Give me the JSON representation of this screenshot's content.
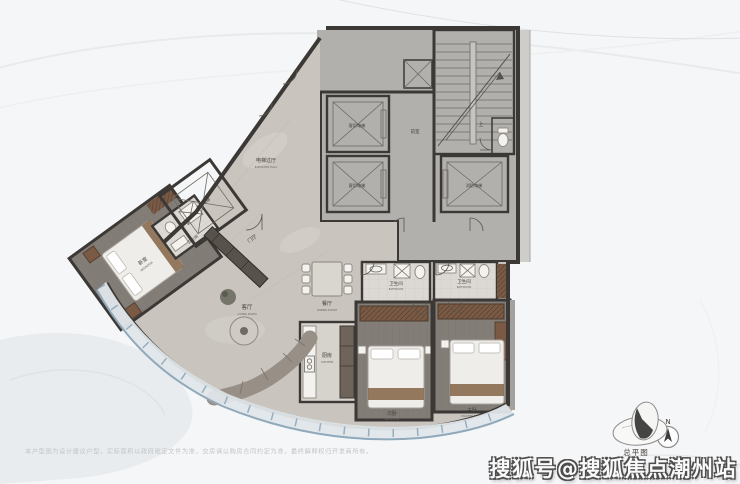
{
  "labels": {
    "elevator_hall": "电梯过厅",
    "elevator_hall_sub": "ELEVATOR HALL",
    "front_room": "前室",
    "up": "上",
    "elevator_passenger": "客用电梯",
    "elevator_fire": "消防电梯",
    "foyer": "门厅",
    "living": "客厅",
    "living_sub": "LIVING ROOM",
    "dining": "餐厅",
    "dining_sub": "DINING ROOM",
    "kitchen": "厨房",
    "kitchen_sub": "KITCHEN",
    "bathroom": "卫生间",
    "bathroom_sub": "BATHROOM",
    "bedroom": "卧室",
    "bedroom_sub": "BEDROOM",
    "bedroom_second": "次卧",
    "bedroom_master": "主卧",
    "bedroom_master_sub": "MASTER ROOM"
  },
  "legend": {
    "north": "N",
    "site_plan": "总平图"
  },
  "footer": {
    "watermark": "搜狐号@搜狐焦点潮州站",
    "disclaimer": "本户型图为设计建议户型，实际面积以政府批定文件为准，交房请以购房合同约定为准，最终解释权归开发商所有。"
  },
  "colors": {
    "wall": "#3b3835",
    "marble": "#c9c4be",
    "core": "#b2b0ad",
    "shaft": "#c7c5c2",
    "floor_wood": "#837d77",
    "bath": "#dcd9d4",
    "wood": "#7a5a45",
    "glass": "#8fa9bb",
    "balcony": "#e0e6ea",
    "label": "#45413b",
    "watermark_outline": "#4e4e4e"
  }
}
